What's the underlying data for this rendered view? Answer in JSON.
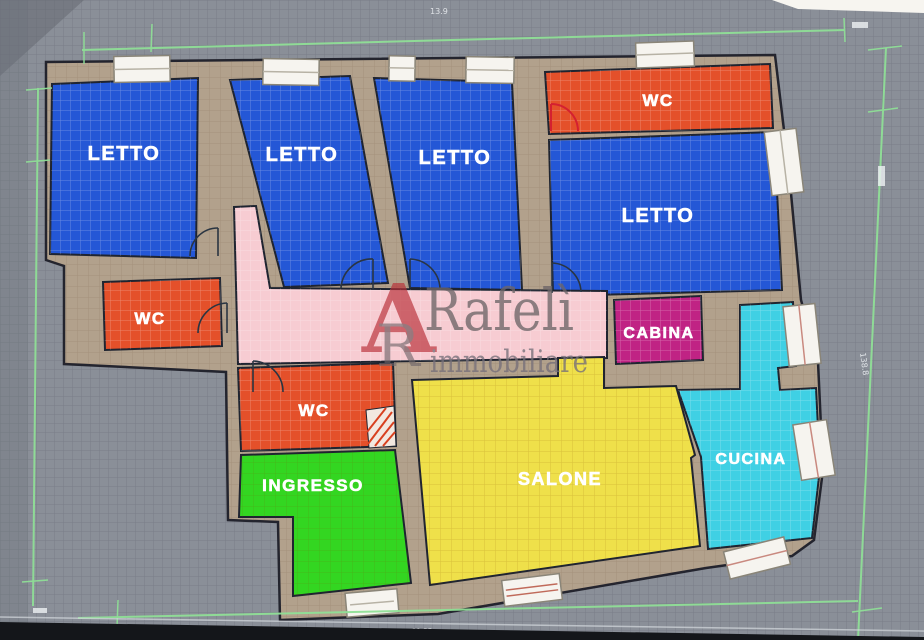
{
  "watermark": {
    "logo_a": "A",
    "logo_r": "R",
    "name": "Rafelì",
    "tagline": "immobiliare"
  },
  "rooms": {
    "letto1": {
      "label": "LETTO"
    },
    "letto2": {
      "label": "LETTO"
    },
    "letto3": {
      "label": "LETTO"
    },
    "letto4": {
      "label": "LETTO"
    },
    "wc_top": {
      "label": "WC"
    },
    "wc_left": {
      "label": "WC"
    },
    "wc_mid": {
      "label": "WC"
    },
    "cabina": {
      "label": "CABINA"
    },
    "cucina": {
      "label": "CUCINA"
    },
    "salone": {
      "label": "SALONE"
    },
    "ingresso": {
      "label": "INGRESSO"
    }
  },
  "dimensions": {
    "top": "13.9",
    "right": "138.8",
    "bottom": "11.38"
  },
  "colors": {
    "background_gray": "#8a8f98",
    "wall_tan": "#b2a18c",
    "bedroom_blue": "#2457d6",
    "wc_orange": "#e4502a",
    "corridor_pink": "#f7ccd2",
    "cabina_magenta": "#c02384",
    "cucina_cyan": "#3fd0e4",
    "salone_yellow": "#efe04a",
    "ingresso_green": "#33d621",
    "measure_green": "#8fdf96",
    "door_red": "#d42030",
    "watermark_red": "#b92f38",
    "watermark_gray": "#6e6669"
  }
}
